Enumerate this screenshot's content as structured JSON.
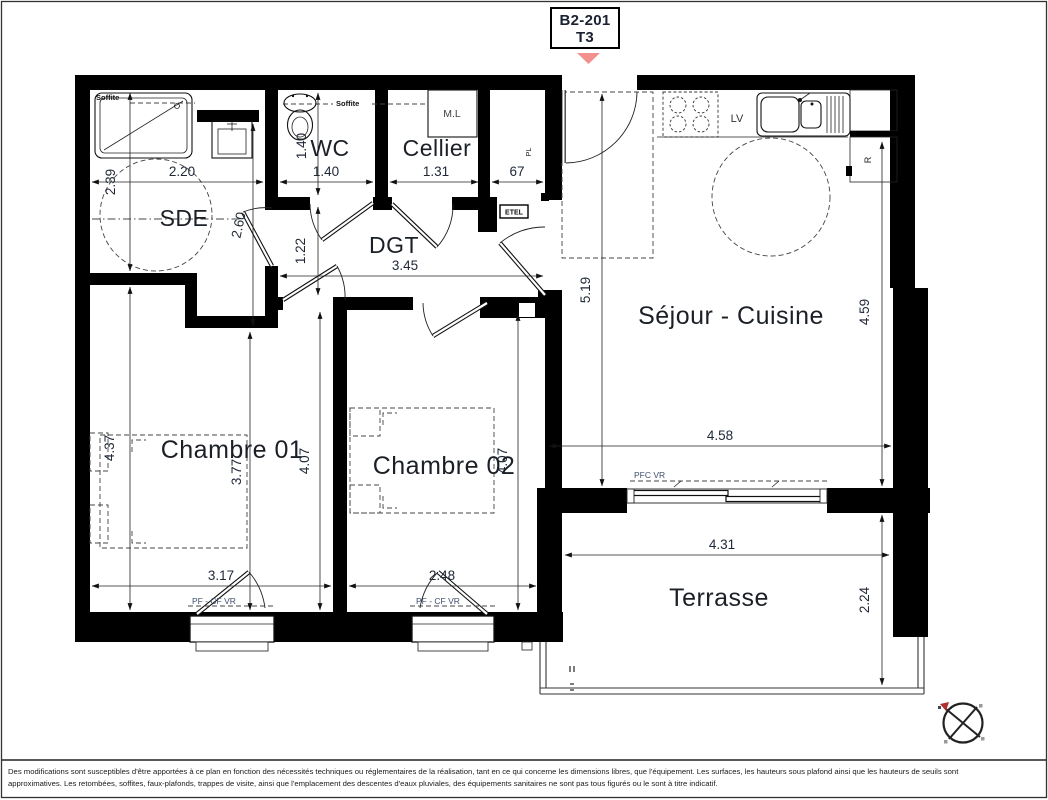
{
  "header": {
    "unit": "B2-201",
    "type": "T3"
  },
  "rooms": {
    "sde": "SDE",
    "wc": "WC",
    "cellier": "Cellier",
    "dgt": "DGT",
    "sejour": "Séjour - Cuisine",
    "ch1": "Chambre 01",
    "ch2": "Chambre 02",
    "terrasse": "Terrasse"
  },
  "labels": {
    "soffite_sde": "Soffite",
    "soffite_wc": "Soffite",
    "washing_machine": "M.L",
    "dishwasher": "LV",
    "fridge": "R",
    "placard": "PL",
    "etel": "ETEL",
    "window_sejour": "PFC VR",
    "window_ch1": "PF - CF VR",
    "window_ch2": "PF - CF VR"
  },
  "dims": {
    "sde_width": "2.20",
    "sde_depth": "2.39",
    "sde_inner": "2.60",
    "wc_depth": "1.40",
    "wc_width": "1.40",
    "cellier_width": "1.31",
    "placard_width": "67",
    "dgt_width": "3.45",
    "dgt_depth": "1.22",
    "sejour_depth": "5.19",
    "sejour_depth_right": "4.59",
    "sejour_width": "4.58",
    "ch1_left": "4.37",
    "ch1_mid": "3.77",
    "ch1_right": "4.07",
    "ch2_right": "4.07",
    "ch1_window": "3.17",
    "ch2_window": "2.48",
    "terrasse_width": "4.31",
    "terrasse_depth": "2.24"
  },
  "colors": {
    "accent_triangle": "#f2908e",
    "wall": "#000000"
  },
  "footer": {
    "line1": "Des modifications sont susceptibles d'être apportées à ce plan en fonction des nécessités techniques ou réglementaires de la réalisation, tant en ce qui concerne les dimensions libres, que l'équipement. Les surfaces, les hauteurs sous plafond ainsi que les hauteurs de seuils sont",
    "line2": "approximatives. Les retombées, soffites, faux-plafonds, trappes de visite, ainsi que l'emplacement des descentes d'eaux pluviales, des équipements sanitaires ne sont pas tous figurés ou le sont à titre indicatif."
  }
}
